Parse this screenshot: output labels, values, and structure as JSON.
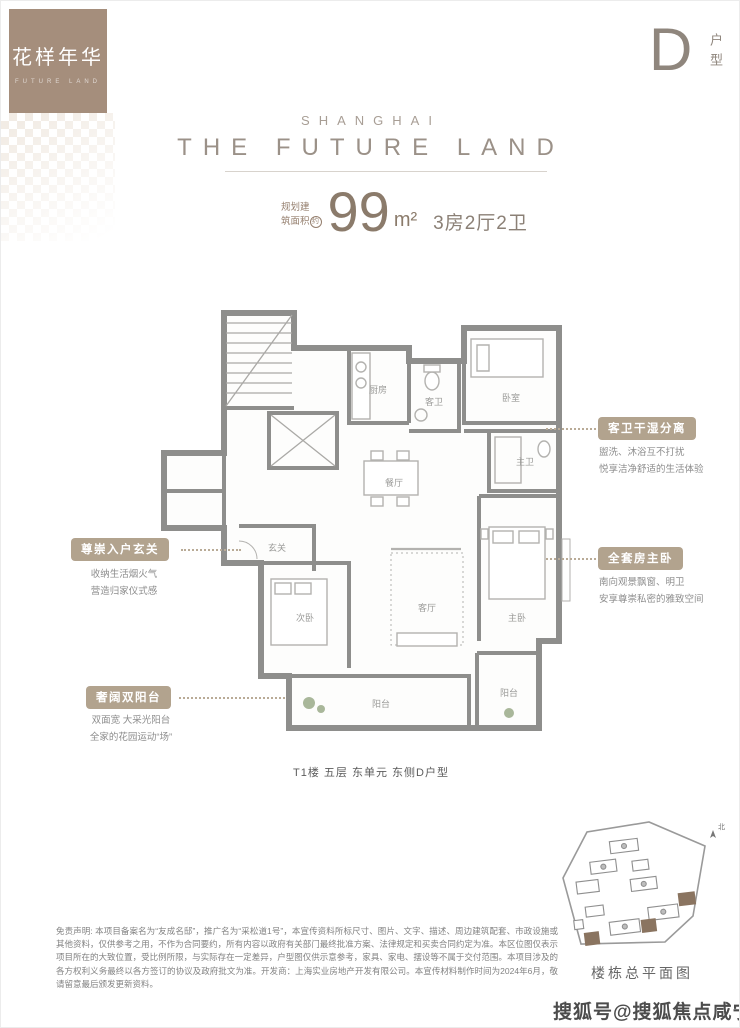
{
  "brand": {
    "logo_title": "花样年华",
    "logo_subtitle": "FUTURE LAND"
  },
  "unit": {
    "letter": "D",
    "label": "户型"
  },
  "header": {
    "city": "SHANGHAI",
    "title": "THE FUTURE LAND"
  },
  "area": {
    "prefix_line1": "规划建",
    "prefix_line2": "筑面积",
    "prefix_circle": "约",
    "value": "99",
    "unit": "m²",
    "layout": "3房2厅2卫"
  },
  "callouts": {
    "bath": {
      "title": "客卫干湿分离",
      "line1": "盥洗、沐浴互不打扰",
      "line2": "悦享洁净舒适的生活体验"
    },
    "master": {
      "title": "全套房主卧",
      "line1": "南向观景飘窗、明卫",
      "line2": "安享尊崇私密的雅致空间"
    },
    "foyer": {
      "title": "尊崇入户玄关",
      "line1": "收纳生活烟火气",
      "line2": "营造归家仪式感"
    },
    "balcony": {
      "title": "奢阔双阳台",
      "line1": "双面宽 大采光阳台",
      "line2": "全家的花园运动“场”"
    }
  },
  "plan": {
    "caption": "T1楼 五层 东单元 东侧D户型",
    "rooms": {
      "kitchen": "厨房",
      "guest_bath": "客卫",
      "bedroom": "卧室",
      "dining": "餐厅",
      "master_bath": "主卫",
      "master": "主卧",
      "foyer": "玄关",
      "second": "次卧",
      "living": "客厅",
      "balcony": "阳台",
      "balcony2": "阳台"
    }
  },
  "site_plan": {
    "caption": "楼栋总平面图",
    "compass": "北"
  },
  "disclaimer": {
    "text": "免责声明: 本项目备案名为“友成名邸”，推广名为“采松道1号”，本宣传资料所标尺寸、图片、文字、描述、周边建筑配套、市政设施或其他资料，仅供参考之用，不作为合同要约，所有内容以政府有关部门最终批准方案、法律规定和买卖合同约定为准。本区位图仅表示项目所在的大致位置，受比例所限，与实际存在一定差异，户型图仅供示意参考，家具、家电、摆设等不属于交付范围。本项目涉及的各方权利义务最终以各方签订的协议及政府批文为准。开发商：上海实业房地产开发有限公司。本宣传材料制作时间为2024年6月，敬请留意最后颁发更新资料。"
  },
  "watermark": "搜狐号@搜狐焦点咸宁站",
  "colors": {
    "brand_brown": "#a58e7c",
    "badge_tan": "#b2a38e",
    "heading_gray": "#9b9188",
    "wall_gray": "#8e8e8c"
  }
}
